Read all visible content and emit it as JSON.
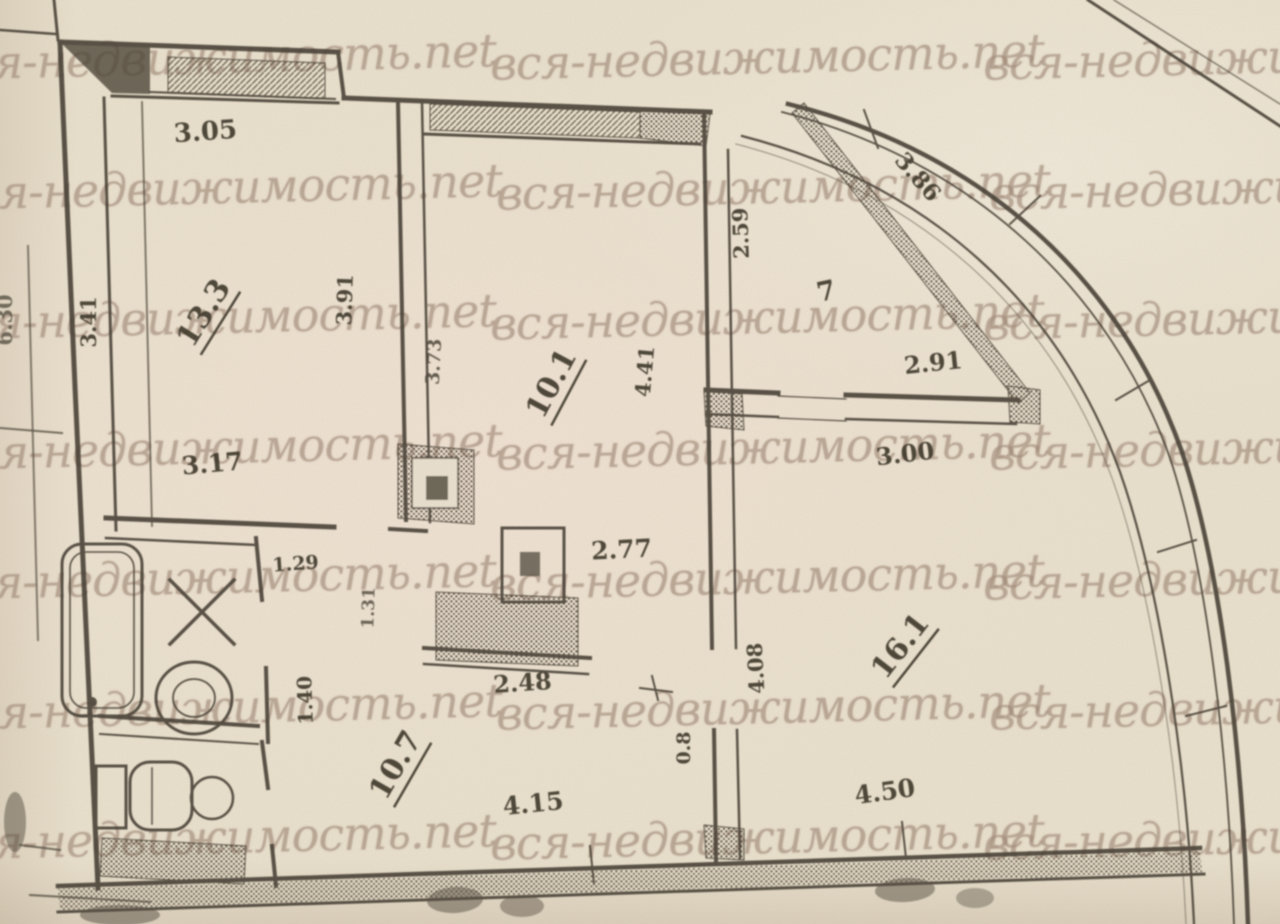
{
  "watermark": {
    "text": "вся-недвижимость.net"
  },
  "plan": {
    "room_labels": {
      "room1": "13.3",
      "kitchen": "10.1",
      "hall": "10.7",
      "room16": "16.1",
      "balcony": "7"
    },
    "dimensions": {
      "room1_top": "3.05",
      "room1_bottom": "3.17",
      "room1_left": "3.41",
      "outer_left": "6.30",
      "room1_right": "3.91",
      "kitchen_left": "3.73",
      "kitchen_right": "4.41",
      "vent_width": "2.77",
      "kitchen_bottom": "2.48",
      "balcony_left": "2.59",
      "balcony_diagonal": "3.86",
      "balcony_bottom": "2.91",
      "room16_top": "3.00",
      "room16_left": "4.08",
      "room16_bottom": "4.50",
      "hall_bottom": "4.15",
      "hall_left": "1.40",
      "door_width": "0.8",
      "bath_width": "1.29",
      "bath_height": "1.31"
    }
  }
}
